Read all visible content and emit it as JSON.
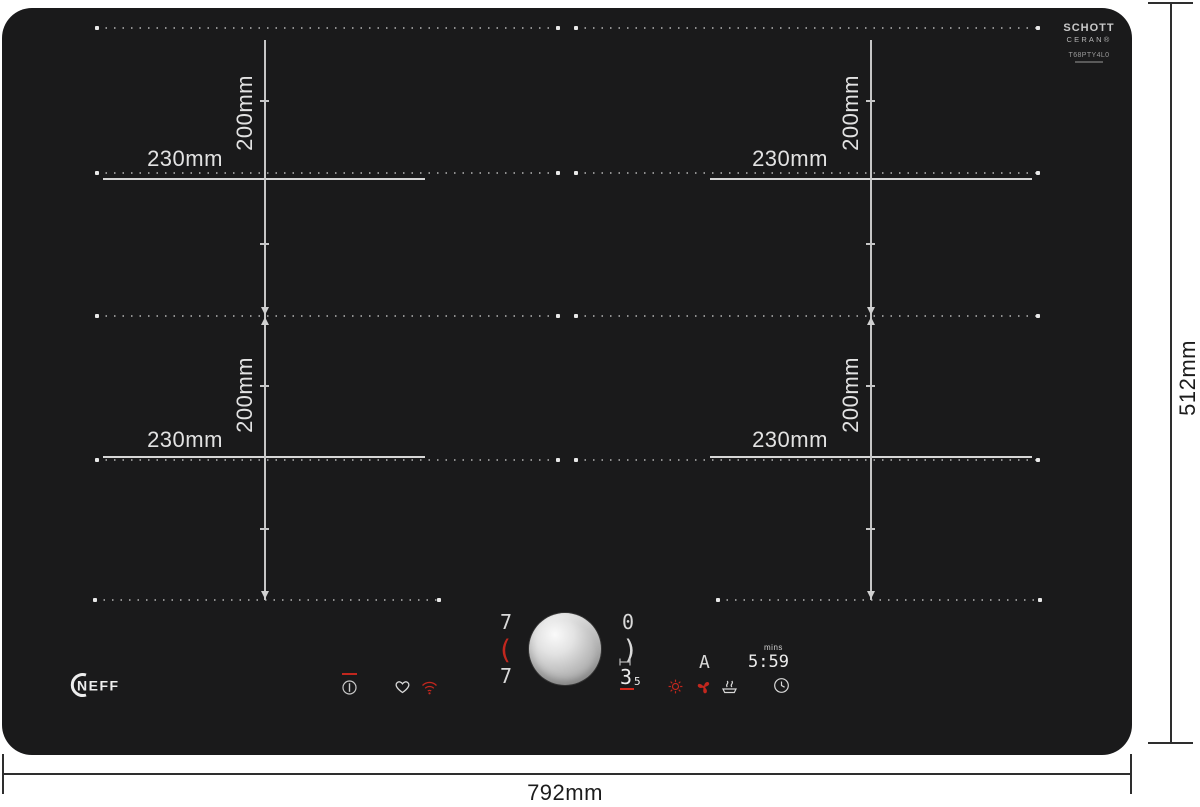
{
  "product": {
    "brand": "NEFF",
    "glass": {
      "maker_line1": "SCHOTT",
      "maker_line2": "CERAN®",
      "model_code": "T68PTY4L0"
    }
  },
  "overall_dimensions": {
    "width": "792mm",
    "height": "512mm"
  },
  "zones": [
    {
      "id": "rear-left-flex",
      "width_label": "230mm",
      "height_label": "200mm"
    },
    {
      "id": "rear-right-flex",
      "width_label": "230mm",
      "height_label": "200mm"
    },
    {
      "id": "front-left-flex",
      "width_label": "230mm",
      "height_label": "200mm"
    },
    {
      "id": "front-right-flex",
      "width_label": "230mm",
      "height_label": "200mm"
    }
  ],
  "control_panel": {
    "left_flex_display": {
      "rear_power": "7",
      "bracket": "(",
      "front_power": "7"
    },
    "right_flex_display": {
      "rear_power": "0",
      "bracket": ")",
      "front_power": "3",
      "front_power_decimal": "5"
    },
    "function_display": {
      "auto_indicator": "A",
      "timer_unit": "mins",
      "timer_value": "5:59"
    },
    "icons": {
      "left": [
        "main-power-icon",
        "favorite-heart-icon",
        "wifi-icon"
      ],
      "center": [
        "flex-bridge-icon",
        "twist-control-knob"
      ],
      "right": [
        "heat-boost-icon",
        "ventilation-fan-icon",
        "keep-warm-icon",
        "timer-clock-icon"
      ]
    }
  },
  "colors": {
    "hob_surface": "#1a1a1b",
    "accent_red": "#c2271e",
    "display_white": "#e8e8e8",
    "guide_gray": "#8f8f8f",
    "dimension_ink": "#1c1c1c"
  }
}
